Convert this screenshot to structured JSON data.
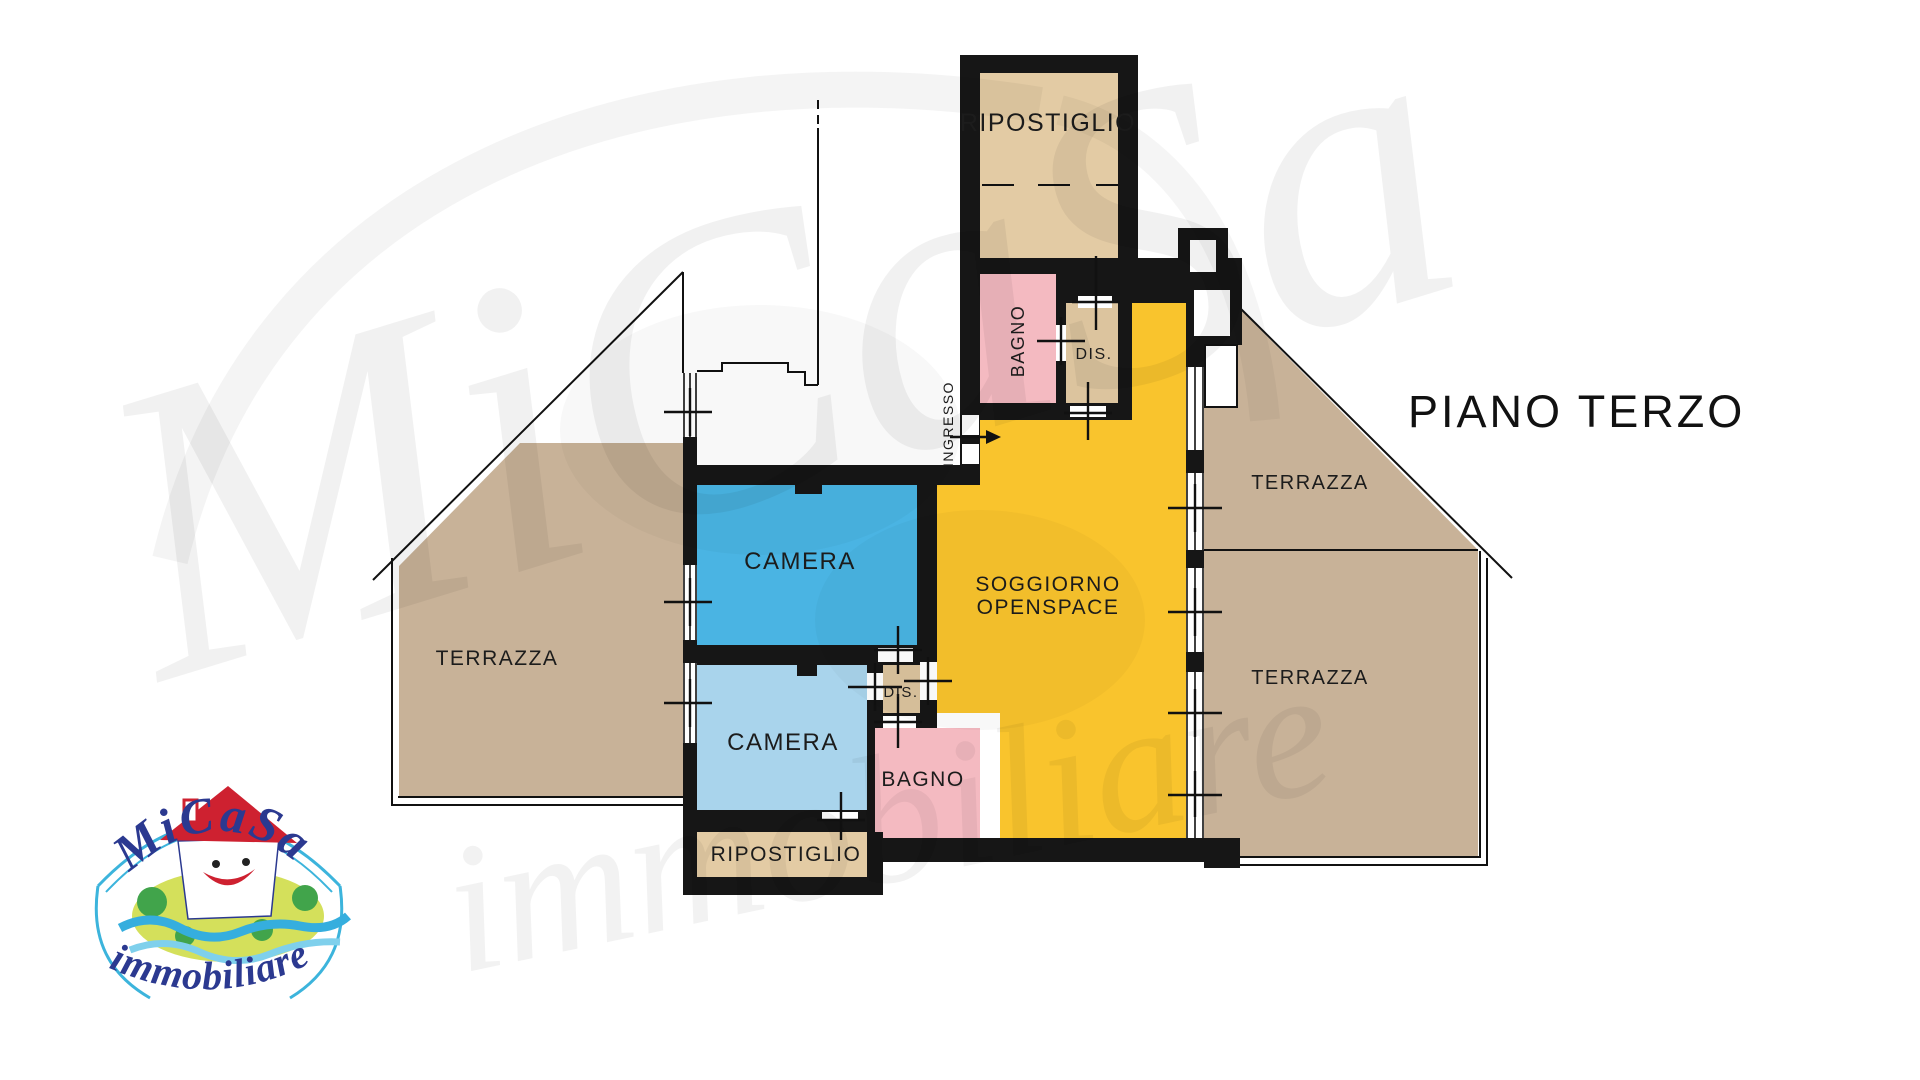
{
  "floor_label": "PIANO TERZO",
  "rooms": {
    "ripostiglio_top": "RIPOSTIGLIO",
    "bagno_top": "BAGNO",
    "dis_top": "DIS.",
    "ingresso": "INGRESSO",
    "camera_1": "CAMERA",
    "camera_2": "CAMERA",
    "soggiorno_line1": "SOGGIORNO",
    "soggiorno_line2": "OPENSPACE",
    "dis_bottom": "DIS.",
    "bagno_bottom": "BAGNO",
    "ripostiglio_bottom": "RIPOSTIGLIO",
    "terrazza_left": "TERRAZZA",
    "terrazza_right_top": "TERRAZZA",
    "terrazza_right_bottom": "TERRAZZA"
  },
  "logo": {
    "brand": "MiCaSa",
    "subtitle": "immobiliare"
  },
  "watermark": {
    "brand": "MiCaSa",
    "subtitle": "immobiliare"
  },
  "colors": {
    "wall": "#161616",
    "room_tan": "#e3cba4",
    "dis_tan": "#dcc49e",
    "terrace_tan": "#c8b298",
    "pink": "#f4bac1",
    "yellow": "#f9c42d",
    "blue_dark": "#4ab4e3",
    "blue_light": "#a9d4ec",
    "label_text": "#1c1c1c",
    "logo_blue": "#2b3990",
    "logo_light_blue": "#3cb4dc",
    "logo_red": "#ce2130",
    "logo_green": "#41a44b",
    "logo_globe": "#d4e05b"
  }
}
